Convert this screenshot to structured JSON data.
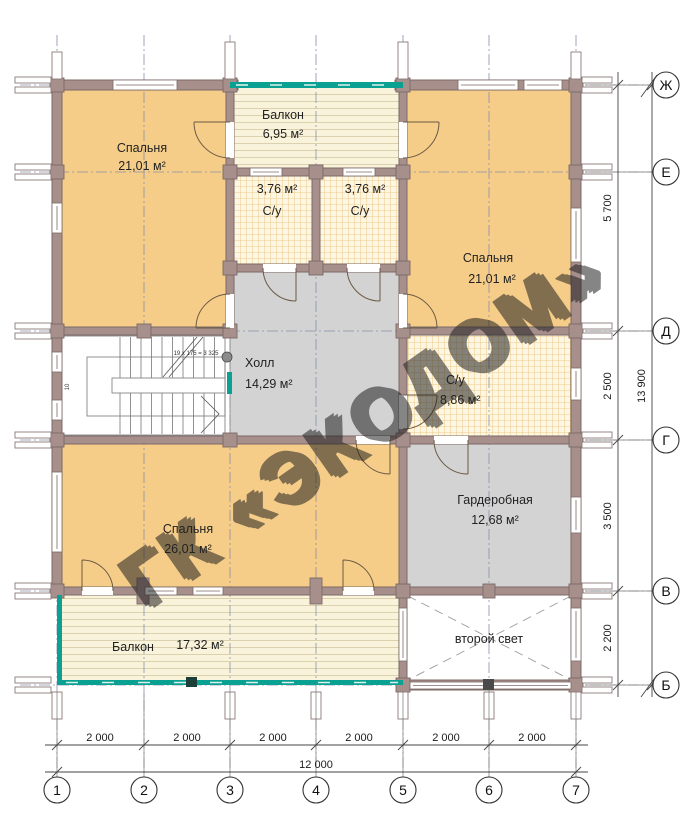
{
  "watermark": {
    "text": "ГК «ЭКОДОМ»"
  },
  "rooms": {
    "bedroom_tl": {
      "label": "Спальня",
      "area": "21,01 м²"
    },
    "balcony_top": {
      "label": "Балкон",
      "area": "6,95 м²"
    },
    "bath_left": {
      "label": "С/у",
      "area": "3,76 м²"
    },
    "bath_right": {
      "label": "С/у",
      "area": "3,76 м²"
    },
    "bedroom_tr": {
      "label": "Спальня",
      "area": "21,01 м²"
    },
    "hall": {
      "label": "Холл",
      "area": "14,29 м²"
    },
    "su": {
      "label": "С/у",
      "area": "8,86 м²"
    },
    "bedroom_b": {
      "label": "Спальня",
      "area": "26,01 м²"
    },
    "wardrobe": {
      "label": "Гардеробная",
      "area": "12,68 м²"
    },
    "balcony_b": {
      "label": "Балкон",
      "area": "17,32 м²"
    },
    "void": {
      "label": "второй свет"
    }
  },
  "stairs": {
    "annotation": "19 x 175 = 3 325",
    "landing_step": "10"
  },
  "axes": {
    "columns": [
      "1",
      "2",
      "3",
      "4",
      "5",
      "6",
      "7"
    ],
    "rows": [
      "Ж",
      "Е",
      "Д",
      "Г",
      "В",
      "Б"
    ]
  },
  "dimensions": {
    "bottom": [
      "2 000",
      "2 000",
      "2 000",
      "2 000",
      "2 000",
      "2 000"
    ],
    "bottom_total": "12 000",
    "right": [
      "5 700",
      "2 500",
      "3 500",
      "2 200"
    ],
    "right_total": "13 900"
  },
  "colors": {
    "room_orange": "#f6cd88",
    "wet_gray": "#d3d3d3",
    "wall": "#a78f8c",
    "railing_teal": "#0aa092"
  }
}
